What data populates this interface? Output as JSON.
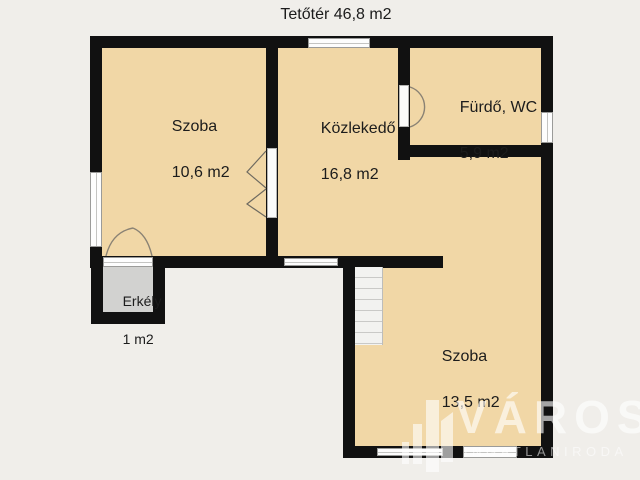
{
  "title": "Tetőtér 46,8 m2",
  "rooms": [
    {
      "name": "Szoba",
      "area": "10,6 m2"
    },
    {
      "name": "Közlekedő",
      "area": "16,8 m2"
    },
    {
      "name": "Fürdő, WC",
      "area": "5,9 m2"
    },
    {
      "name": "Szoba",
      "area": "13,5 m2"
    },
    {
      "name": "Erkély",
      "area": "1 m2"
    }
  ],
  "watermark": {
    "brand": "VÁROSI",
    "tagline": "INGATLANIRODA"
  },
  "colors": {
    "floor": "#f1d7a6",
    "wall": "#111111",
    "background": "#f0eeea",
    "balcony_floor": "#d2d2d0",
    "window": "#fdfdfd",
    "watermark": "#ffffff"
  }
}
